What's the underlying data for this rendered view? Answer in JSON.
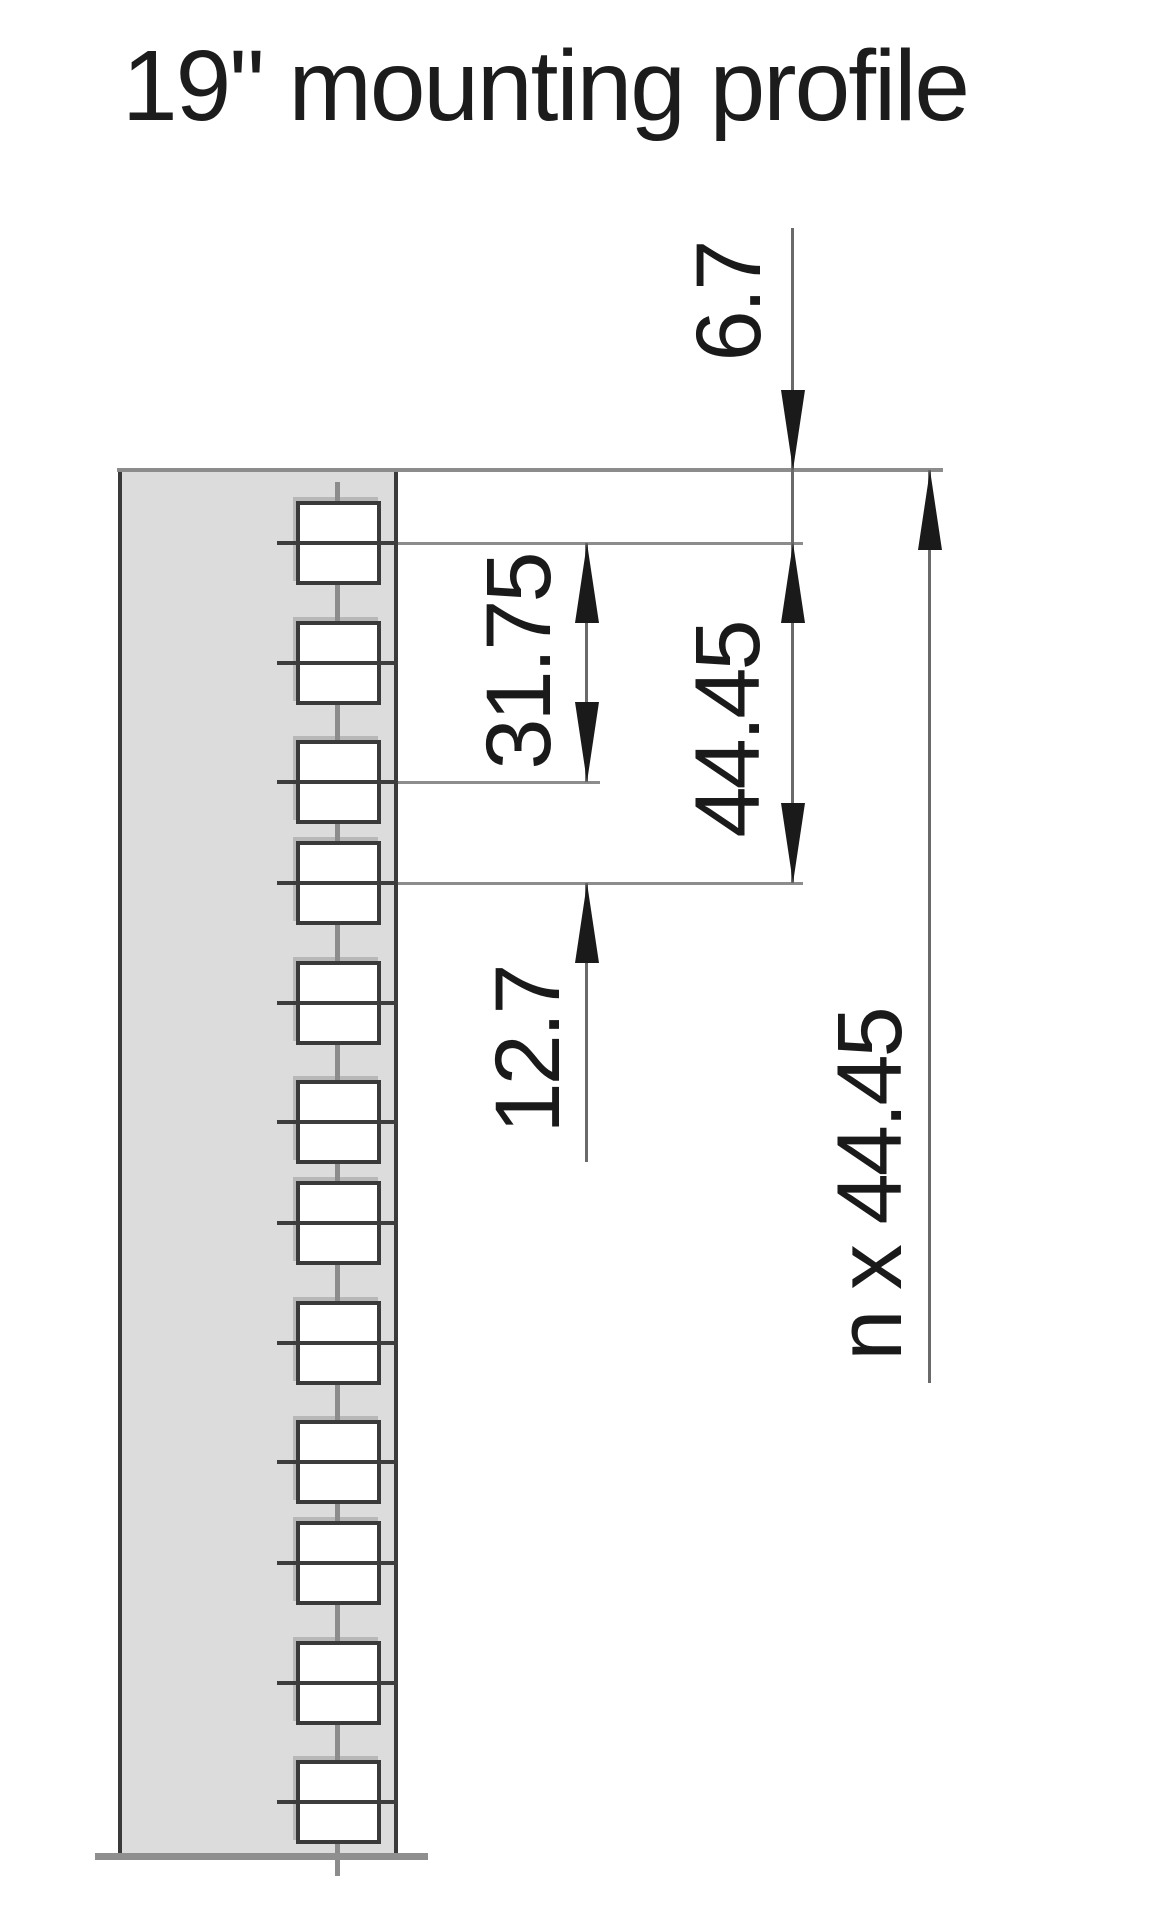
{
  "title": "19\" mounting profile",
  "dimensions": {
    "edge_to_first_hole": {
      "label": "6.7"
    },
    "first_to_third_hole": {
      "label": "31.75"
    },
    "rack_unit_pitch": {
      "label": "44.45"
    },
    "hole_gap": {
      "label": "12.7"
    },
    "total_height": {
      "label": "n x 44.45"
    }
  },
  "profile": {
    "hole_count": 12,
    "hole_shape": "square"
  },
  "geometry": {
    "hole_centers_px": [
      543,
      663,
      782,
      883,
      1003,
      1122,
      1223,
      1343,
      1462,
      1563,
      1683,
      1802
    ],
    "hole_extensions_px": [
      {
        "center": 543,
        "end": 803
      },
      {
        "center": 782,
        "end": 600
      },
      {
        "center": 883,
        "end": 803
      }
    ]
  },
  "colors": {
    "profile_fill": "#dcdcdc",
    "profile_outline": "#3a3a3a",
    "hole_outline": "#3a3a3a",
    "cross_line": "#3d3d3d",
    "extension_line": "#8c8c8c",
    "dimension_line": "#6a6a6a",
    "ink": "#1a1a1a"
  }
}
